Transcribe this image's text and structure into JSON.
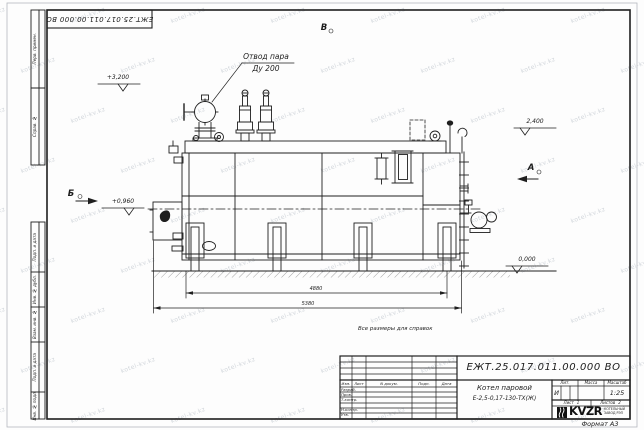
{
  "colors": {
    "line": "#1f1f1f",
    "watermark": "#c3c9d0",
    "logo": "#111111"
  },
  "sheet": {
    "format_label": "Формат А3",
    "reference_note": "Все размеры для справок",
    "watermark": "kotel-kv.kz",
    "top_stamp": "ЕЖТ.25.017.011.00.000  ВО"
  },
  "frame": {
    "left_top_cells": [
      "Перв. примен.",
      "Справ. №"
    ],
    "left_bottom_cells": [
      "Подп. и дата",
      "Инв. № дубл.",
      "Взам. инв. №",
      "Подп. и дата",
      "Инв. № подл."
    ]
  },
  "drawing": {
    "callout_line1": "Отвод пара",
    "callout_line2": "Ду 200",
    "elevations": {
      "top": "+3,200",
      "right_top": "2,400",
      "left_mid": "+0,960",
      "ground": "0,000"
    },
    "views": {
      "b": "Б",
      "v": "В",
      "a": "А"
    },
    "dims": {
      "inner": "4880",
      "overall": "5380"
    }
  },
  "title_block": {
    "doc_number": "ЕЖТ.25.017.011.00.000  ВО",
    "product_name_line1": "Котел паровой",
    "product_name_line2": "Е-2,5-0,17-130-ТХ(Ж)",
    "col_izm": "Изм.",
    "col_list": "Лист",
    "col_doc": "N докум.",
    "col_podp": "Подп.",
    "col_data": "Дата",
    "row_razrab": "Разраб.",
    "row_prov": "Пров.",
    "row_tkontr": "Т.контр.",
    "row_nkontr": "Н.контр.",
    "row_utv": "Утв.",
    "lit_label": "Лит.",
    "lit_value": "И",
    "mass_label": "Масса",
    "scale_label": "Масштаб",
    "scale_value": "1:25",
    "sheet_label": "Лист",
    "sheet_value": "1",
    "sheets_label": "Листов",
    "sheets_value": "2",
    "logo_text": "KVZR",
    "logo_caption_line1": "КОТЕЛЬНЫЙ",
    "logo_caption_line2": "ЗАВОД РЭП"
  }
}
